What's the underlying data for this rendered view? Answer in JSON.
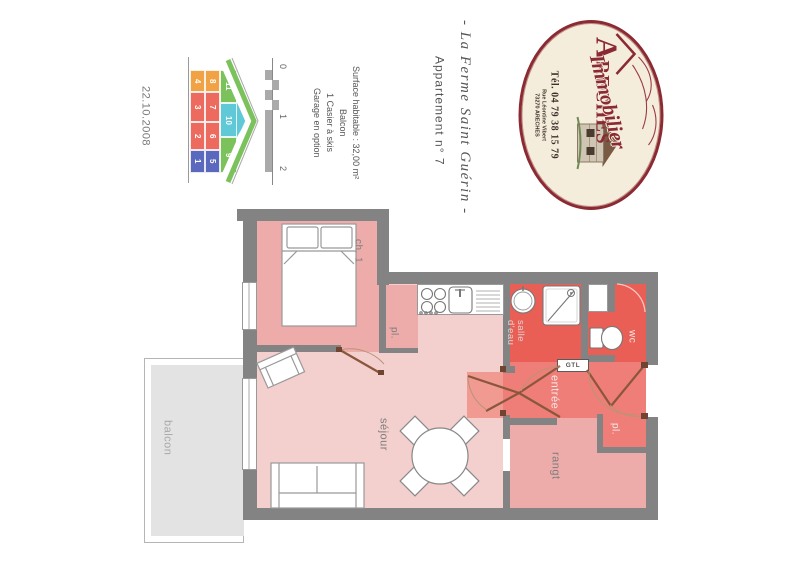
{
  "document": {
    "date": "22.10.2008",
    "title_script": "- La Ferme Saint Guérin -",
    "title_sub": "Appartement n° 7",
    "info_lines": [
      "Surface habitable : 32,00 m²",
      "Balcon",
      "1 Casier à skis",
      "Garage en option"
    ],
    "scale_labels": [
      "0",
      "1",
      "2"
    ]
  },
  "key_plan": {
    "units": [
      {
        "label": "4",
        "color": "orange"
      },
      {
        "label": "8",
        "color": "orange"
      },
      {
        "label": "3",
        "color": "red"
      },
      {
        "label": "7",
        "color": "red"
      },
      {
        "label": "2",
        "color": "red"
      },
      {
        "label": "6",
        "color": "red"
      },
      {
        "label": "1",
        "color": "blue"
      },
      {
        "label": "5",
        "color": "blue"
      },
      {
        "label": "11",
        "color": "green"
      },
      {
        "label": "10",
        "color": "cyan"
      },
      {
        "label": "9",
        "color": "green"
      }
    ],
    "palette": {
      "orange": "#f0a245",
      "red": "#ed6a5f",
      "blue": "#5a68bd",
      "green": "#7cc25c",
      "cyan": "#5fc9d8"
    }
  },
  "logo": {
    "name_main": "ARECHES",
    "name_sub": "Immobilier",
    "phone": "Tél. 04 79 38 15 79",
    "address_line1": "Rue Léontine Vibert",
    "address_line2": "73270 ARECHES"
  },
  "plan": {
    "labels": {
      "bedroom": "ch. 1",
      "closet1": "pl.",
      "living": "séjour",
      "balcony": "balcon",
      "storage": "rangt",
      "shower_room": "salle d'eau",
      "wc": "wc",
      "entry": "entrée",
      "closet2": "pl.",
      "gtl": "GTL"
    }
  },
  "colors": {
    "wall": "#838383",
    "room_pink": "#edacaa",
    "room_light_pink": "#f3cfce",
    "room_red": "#e95e55",
    "room_coral": "#ee7e77",
    "room_coral_light": "#f19a92",
    "balcony_gray": "#e3e3e3",
    "door_brown": "#8a573c",
    "logo_red": "#8b2a33",
    "logo_cream": "#f4eddc"
  }
}
